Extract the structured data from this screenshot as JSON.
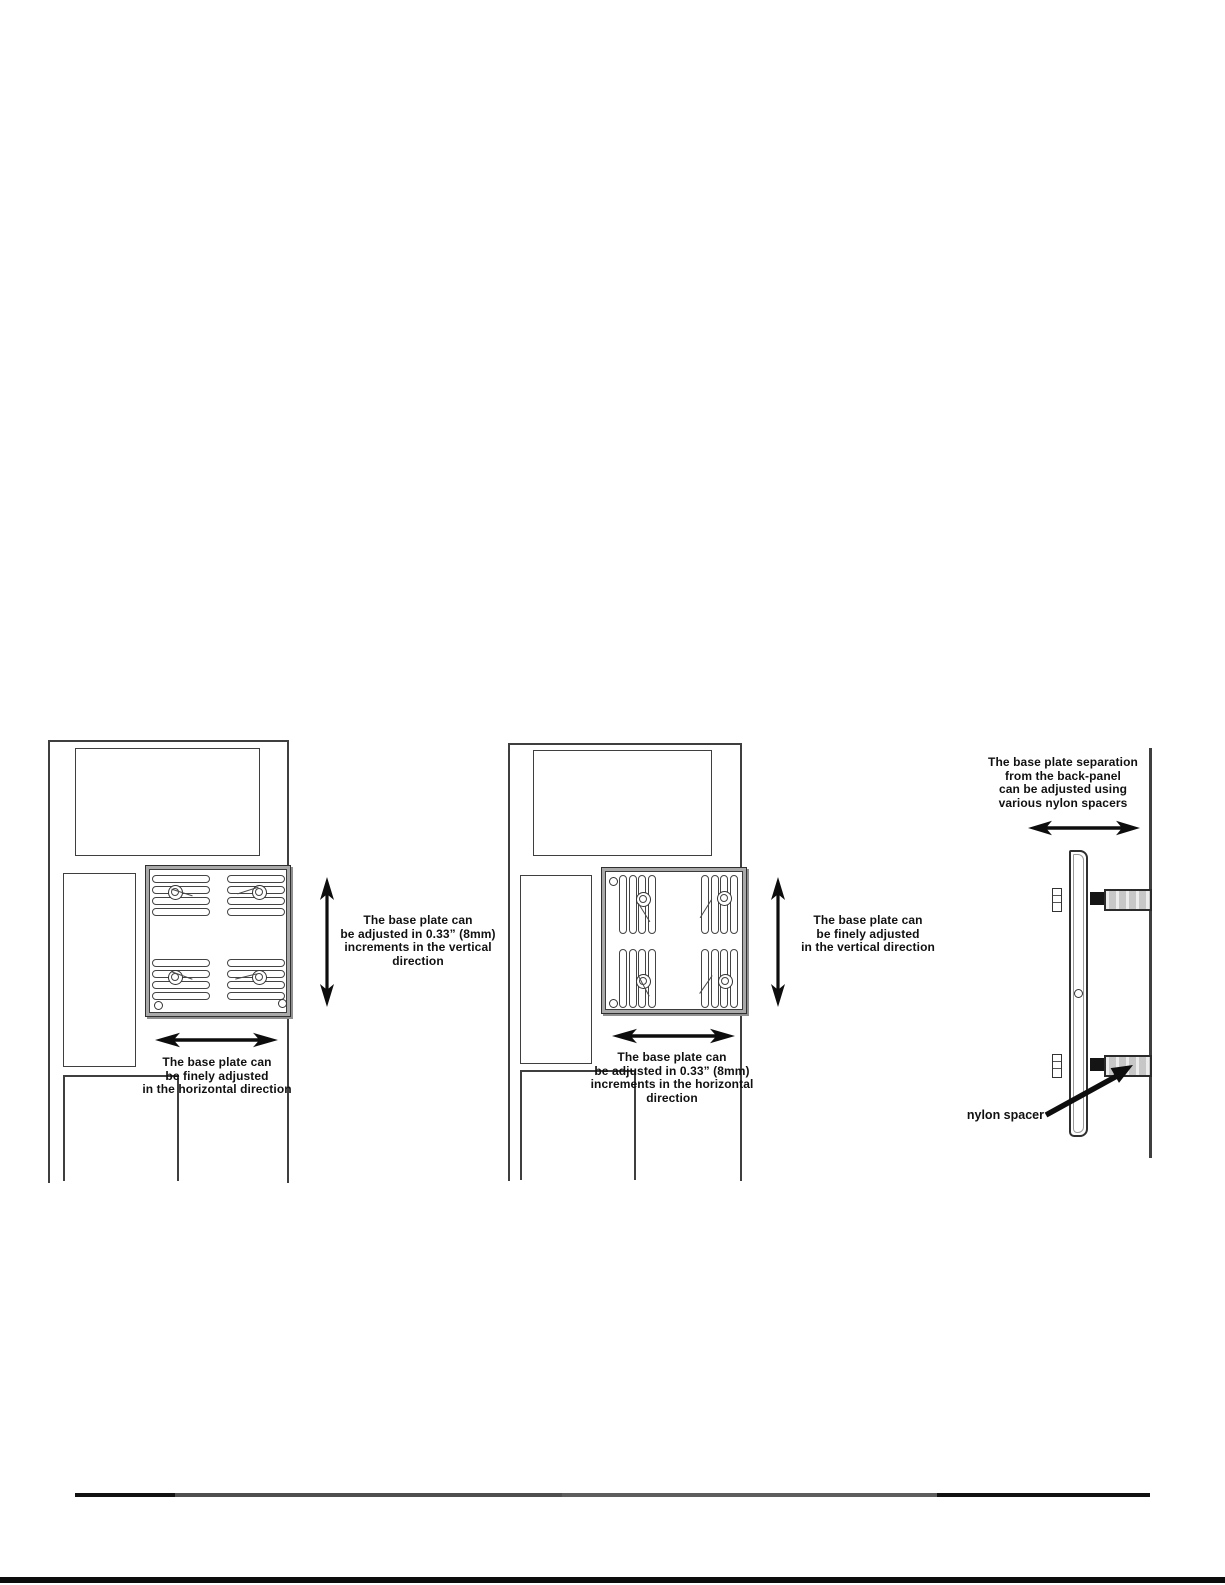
{
  "page": {
    "type": "manual-diagram-page"
  },
  "colors": {
    "line": "#3f3f3f",
    "plate_border_gray": "#a9a9a9",
    "text": "#111111",
    "arrow": "#0d0d0d",
    "spacer_fill": "#c7c7c7",
    "screw_head": "#151515"
  },
  "diagrams": {
    "left_panel": {
      "vertical_note": {
        "lines": [
          "The base plate can",
          "be adjusted in 0.33” (8mm)",
          "increments in the vertical",
          "direction"
        ]
      },
      "horizontal_note": {
        "lines": [
          "The base plate can",
          "be finely adjusted",
          "in the horizontal direction"
        ]
      }
    },
    "middle_panel": {
      "vertical_note": {
        "lines": [
          "The base plate can",
          "be finely adjusted",
          "in the vertical direction"
        ]
      },
      "horizontal_note": {
        "lines": [
          "The base plate can",
          "be adjusted in 0.33” (8mm)",
          "increments in the horizontal",
          "direction"
        ]
      }
    },
    "side_view": {
      "separation_note": {
        "lines": [
          "The base plate separation",
          "from the back-panel",
          "can be adjusted using",
          "various nylon spacers"
        ]
      },
      "spacer_label": "nylon spacer"
    }
  }
}
